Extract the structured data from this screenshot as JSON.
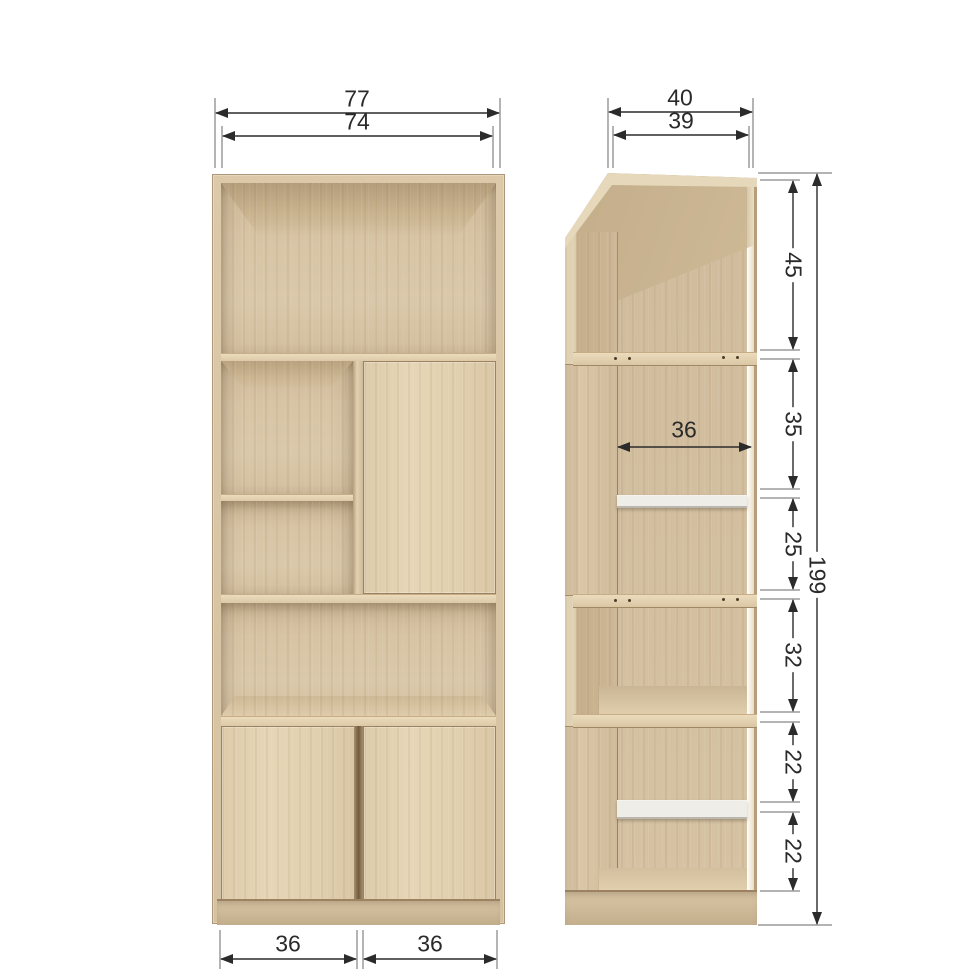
{
  "diagram": {
    "colors": {
      "background": "#ffffff",
      "dimension_line": "#2b2b2b",
      "extension_line": "#6a6a6a",
      "text": "#2a2a2a",
      "wood_light": "#e0cfae",
      "wood_mid": "#d4c1a2",
      "wood_dark": "#c2ac8a",
      "white_shelf": "#efede8"
    },
    "front_view": {
      "width_total": "77",
      "width_inner": "74",
      "bottom_widths": [
        "36",
        "36"
      ]
    },
    "side_view": {
      "depth_total": "40",
      "depth_inner": "39",
      "interior_width": "36",
      "height_total": "199",
      "height_segments": [
        "45",
        "35",
        "25",
        "32",
        "22",
        "22"
      ]
    }
  }
}
